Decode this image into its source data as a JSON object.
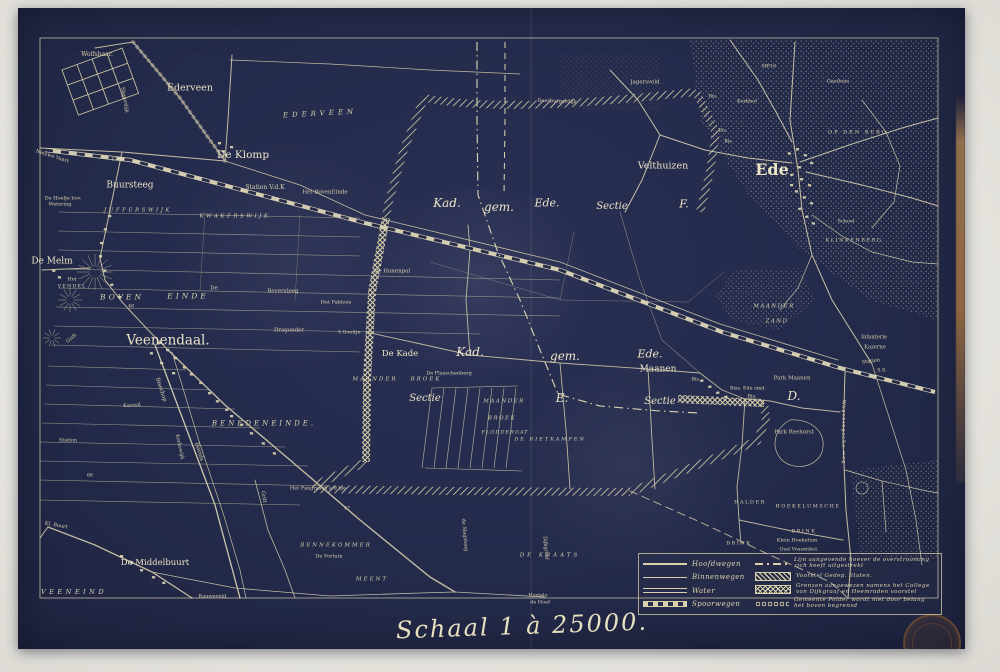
{
  "map": {
    "scale_label": "Schaal 1 à 25000.",
    "colors": {
      "sheet_navy": "#242a4a",
      "line_cream": "#d8d0ae",
      "bright_cream": "#ece5cb",
      "paper": "#e8e6e0",
      "stamp_brown": "#7a522e",
      "binding_tan": "#ba8a52"
    },
    "legend": {
      "left": [
        {
          "label": "Hoofdwegen",
          "symbol": "road-main"
        },
        {
          "label": "Binnenwegen",
          "symbol": "road-inner"
        },
        {
          "label": "Water",
          "symbol": "water"
        },
        {
          "label": "Spoorwegen",
          "symbol": "rail"
        }
      ],
      "right": [
        {
          "label": "Lijn aangevende hoever de overstrooming zich heeft uitgestrekt",
          "symbol": "dashdot"
        },
        {
          "label": "Voorstel Gedep. Staten.",
          "symbol": "hatch"
        },
        {
          "label": "Grenzen aangewezen namens het College van Dijkgraaf en Heemraden voorstel",
          "symbol": "crosshatch"
        },
        {
          "label": "Gemeente Polder wordt niet door belang het boven begrensd",
          "symbol": "chain"
        }
      ]
    },
    "labels": [
      {
        "t": "Wolfshaar.",
        "x": 97,
        "y": 55,
        "s": 6
      },
      {
        "t": "Ederveen",
        "x": 190,
        "y": 88,
        "s": 9.5
      },
      {
        "t": "EDERVEEN",
        "x": 320,
        "y": 114,
        "s": 7,
        "ls": 4,
        "r": -3,
        "i": 1
      },
      {
        "t": "De Klomp",
        "x": 243,
        "y": 155,
        "s": 10.5
      },
      {
        "t": "Station V.d.K",
        "x": 265,
        "y": 188,
        "s": 6
      },
      {
        "t": "Het BovenEinde",
        "x": 325,
        "y": 193,
        "s": 5.5
      },
      {
        "t": "Buursteeg",
        "x": 130,
        "y": 186,
        "s": 9
      },
      {
        "t": "JUFFERSWIJK",
        "x": 138,
        "y": 211,
        "s": 5.5,
        "ls": 2.5,
        "i": 1
      },
      {
        "t": "KWAKERSWIJK",
        "x": 235,
        "y": 217,
        "s": 5.5,
        "ls": 2.5,
        "i": 1
      },
      {
        "t": "De Hoefje bov.",
        "x": 63,
        "y": 199,
        "s": 5
      },
      {
        "t": "Wetering",
        "x": 60,
        "y": 205,
        "s": 5
      },
      {
        "t": "De Melm",
        "x": 52,
        "y": 262,
        "s": 9
      },
      {
        "t": "Het",
        "x": 72,
        "y": 280,
        "s": 5
      },
      {
        "t": "VENDEL",
        "x": 72,
        "y": 287,
        "s": 5,
        "ls": 1
      },
      {
        "t": "BOVEN",
        "x": 122,
        "y": 297,
        "s": 7.5,
        "ls": 3,
        "i": 1
      },
      {
        "t": "EINDE",
        "x": 188,
        "y": 296,
        "s": 7.5,
        "ls": 3,
        "i": 1
      },
      {
        "t": "De",
        "x": 214,
        "y": 289,
        "s": 5.5
      },
      {
        "t": "Beversteeg",
        "x": 283,
        "y": 292,
        "s": 5.5
      },
      {
        "t": "Het Pakhuis",
        "x": 336,
        "y": 303,
        "s": 5
      },
      {
        "t": "De Hanenpol",
        "x": 392,
        "y": 272,
        "s": 5.5
      },
      {
        "t": "Veenendaal.",
        "x": 168,
        "y": 341,
        "s": 13.5
      },
      {
        "t": "Dragonder",
        "x": 289,
        "y": 331,
        "s": 5.5
      },
      {
        "t": "'t Gooitje",
        "x": 349,
        "y": 333,
        "s": 5
      },
      {
        "t": "Grift",
        "x": 72,
        "y": 339,
        "s": 5,
        "r": -40
      },
      {
        "t": "Nieuwe Vaart",
        "x": 52,
        "y": 157,
        "s": 5,
        "r": 18
      },
      {
        "t": "123",
        "x": 116,
        "y": 161,
        "s": 4.8
      },
      {
        "t": "48",
        "x": 131,
        "y": 308,
        "s": 4.8
      },
      {
        "t": "Slaperdijk",
        "x": 124,
        "y": 100,
        "s": 5,
        "r": 80
      },
      {
        "t": "Bisschop",
        "x": 160,
        "y": 390,
        "s": 5.5,
        "r": 72
      },
      {
        "t": "Davids",
        "x": 198,
        "y": 452,
        "s": 5.5,
        "r": 72
      },
      {
        "t": "Kanaal",
        "x": 132,
        "y": 406,
        "s": 5,
        "r": -4
      },
      {
        "t": "Kerkewijk",
        "x": 179,
        "y": 447,
        "s": 5,
        "r": 78
      },
      {
        "t": "BENEDENEINDE.",
        "x": 264,
        "y": 424,
        "s": 7,
        "ls": 3,
        "i": 1
      },
      {
        "t": "Station",
        "x": 68,
        "y": 441,
        "s": 5
      },
      {
        "t": "De Middelbuurt",
        "x": 155,
        "y": 563,
        "s": 8.5
      },
      {
        "t": "VEENEIND",
        "x": 74,
        "y": 592,
        "s": 6.5,
        "ls": 3.5,
        "i": 1
      },
      {
        "t": "Rauweveld.",
        "x": 213,
        "y": 597,
        "s": 5
      },
      {
        "t": "Kl. Buurt",
        "x": 56,
        "y": 526,
        "s": 5,
        "r": 10
      },
      {
        "t": "Het Pangrasch a/d bje",
        "x": 318,
        "y": 489,
        "s": 5
      },
      {
        "t": "BENNEKOMMER",
        "x": 336,
        "y": 546,
        "s": 5.5,
        "ls": 2,
        "i": 1
      },
      {
        "t": "De Fortuin",
        "x": 329,
        "y": 557,
        "s": 5
      },
      {
        "t": "MEENT",
        "x": 372,
        "y": 580,
        "s": 5.5,
        "ls": 2,
        "i": 1
      },
      {
        "t": "DE KRAATS",
        "x": 550,
        "y": 556,
        "s": 5.5,
        "ls": 3,
        "i": 1
      },
      {
        "t": "Hartelo",
        "x": 538,
        "y": 596,
        "s": 5
      },
      {
        "t": "de Hoef",
        "x": 540,
        "y": 603,
        "s": 5
      },
      {
        "t": "Grift",
        "x": 263,
        "y": 497,
        "s": 5,
        "r": 80
      },
      {
        "t": "de Slagsteeg",
        "x": 464,
        "y": 535,
        "s": 5,
        "r": 85
      },
      {
        "t": "Dijkgraaf",
        "x": 545,
        "y": 548,
        "s": 5,
        "r": 85
      },
      {
        "t": "47",
        "x": 347,
        "y": 510,
        "s": 4.8
      },
      {
        "t": "66",
        "x": 90,
        "y": 477,
        "s": 4.8
      },
      {
        "t": "MAANDER",
        "x": 375,
        "y": 380,
        "s": 5.5,
        "ls": 2,
        "i": 1
      },
      {
        "t": "BROEK",
        "x": 426,
        "y": 380,
        "s": 5.5,
        "ls": 2,
        "i": 1
      },
      {
        "t": "Sectie",
        "x": 425,
        "y": 399,
        "s": 10,
        "i": 1
      },
      {
        "t": "De Kade",
        "x": 400,
        "y": 354,
        "s": 8.5
      },
      {
        "t": "Kad.",
        "x": 447,
        "y": 203,
        "s": 12,
        "i": 1
      },
      {
        "t": "gem.",
        "x": 499,
        "y": 207,
        "s": 12,
        "i": 1
      },
      {
        "t": "Ede.",
        "x": 547,
        "y": 203,
        "s": 11,
        "i": 1
      },
      {
        "t": "Sectie",
        "x": 612,
        "y": 207,
        "s": 10,
        "i": 1
      },
      {
        "t": "F.",
        "x": 684,
        "y": 204,
        "s": 11,
        "i": 1
      },
      {
        "t": "Kad.",
        "x": 470,
        "y": 352,
        "s": 12,
        "i": 1
      },
      {
        "t": "gem.",
        "x": 565,
        "y": 356,
        "s": 12,
        "i": 1
      },
      {
        "t": "Ede.",
        "x": 650,
        "y": 354,
        "s": 11,
        "i": 1
      },
      {
        "t": "Maanen",
        "x": 658,
        "y": 370,
        "s": 9
      },
      {
        "t": "E.",
        "x": 562,
        "y": 398,
        "s": 12,
        "i": 1
      },
      {
        "t": "Sectie",
        "x": 660,
        "y": 402,
        "s": 10,
        "i": 1
      },
      {
        "t": "D.",
        "x": 794,
        "y": 396,
        "s": 12,
        "i": 1
      },
      {
        "t": "MAANDER",
        "x": 504,
        "y": 402,
        "s": 5.5,
        "ls": 1.5,
        "i": 1
      },
      {
        "t": "BROEK",
        "x": 502,
        "y": 419,
        "s": 5.5,
        "ls": 1.5,
        "i": 1
      },
      {
        "t": "FLODDERGAT",
        "x": 505,
        "y": 433,
        "s": 5,
        "ls": 1,
        "i": 1
      },
      {
        "t": "DE RIETKAMPEN",
        "x": 550,
        "y": 440,
        "s": 5,
        "ls": 2,
        "i": 1
      },
      {
        "t": "De Plasschenberg",
        "x": 449,
        "y": 374,
        "s": 5
      },
      {
        "t": "Doesburgerdijk",
        "x": 557,
        "y": 102,
        "s": 5,
        "r": 2
      },
      {
        "t": "Velthuizen",
        "x": 663,
        "y": 166,
        "s": 9.5
      },
      {
        "t": "Jagersveld",
        "x": 645,
        "y": 83,
        "s": 5.5
      },
      {
        "t": "Ede",
        "x": 772,
        "y": 170,
        "s": 16,
        "b": 1
      },
      {
        "t": "OP DEN BERG",
        "x": 858,
        "y": 133,
        "s": 5,
        "ls": 2
      },
      {
        "t": "Gasthuis",
        "x": 838,
        "y": 82,
        "s": 5
      },
      {
        "t": "Kerkhof",
        "x": 747,
        "y": 102,
        "s": 5
      },
      {
        "t": "MP16",
        "x": 769,
        "y": 68,
        "s": 4.8
      },
      {
        "t": "Bis.",
        "x": 713,
        "y": 98,
        "s": 4.8
      },
      {
        "t": "Bis.",
        "x": 723,
        "y": 132,
        "s": 4.8
      },
      {
        "t": "Bis",
        "x": 728,
        "y": 143,
        "s": 4.8
      },
      {
        "t": "School",
        "x": 846,
        "y": 222,
        "s": 5
      },
      {
        "t": "KLINKENBERG",
        "x": 854,
        "y": 241,
        "s": 5,
        "ls": 1.5
      },
      {
        "t": "MAANDER",
        "x": 774,
        "y": 307,
        "s": 5.5,
        "ls": 1.5,
        "i": 1
      },
      {
        "t": "ZAND",
        "x": 777,
        "y": 322,
        "s": 5.5,
        "ls": 1.5,
        "i": 1
      },
      {
        "t": "Infanterie",
        "x": 874,
        "y": 338,
        "s": 5.2
      },
      {
        "t": "Kazerne",
        "x": 875,
        "y": 348,
        "s": 5.2
      },
      {
        "t": "Station",
        "x": 871,
        "y": 362,
        "s": 5,
        "r": -8
      },
      {
        "t": "S.S.",
        "x": 882,
        "y": 371,
        "s": 5
      },
      {
        "t": "Park Maanen",
        "x": 792,
        "y": 379,
        "s": 5.5
      },
      {
        "t": "Biss. Ede omd.",
        "x": 748,
        "y": 390,
        "s": 4.8
      },
      {
        "t": "Bis.",
        "x": 752,
        "y": 398,
        "s": 4.8
      },
      {
        "t": "Bis.",
        "x": 696,
        "y": 381,
        "s": 4.8
      },
      {
        "t": "Park Reehorst",
        "x": 794,
        "y": 433,
        "s": 5.5
      },
      {
        "t": "HALDER",
        "x": 750,
        "y": 503,
        "s": 5,
        "ls": 1.5
      },
      {
        "t": "HOEKELUMSCHE",
        "x": 808,
        "y": 507,
        "s": 5,
        "ls": 1.5
      },
      {
        "t": "BRINK",
        "x": 739,
        "y": 544,
        "s": 5,
        "ls": 1.5
      },
      {
        "t": "BRINK",
        "x": 804,
        "y": 532,
        "s": 5,
        "ls": 1.5
      },
      {
        "t": "Klein Hoekelum",
        "x": 797,
        "y": 541,
        "s": 5
      },
      {
        "t": "Oud Vossenhol.",
        "x": 799,
        "y": 550,
        "s": 5
      },
      {
        "t": "Wageningsche weg",
        "x": 843,
        "y": 432,
        "s": 5,
        "r": 90,
        "ls": 1
      }
    ]
  }
}
